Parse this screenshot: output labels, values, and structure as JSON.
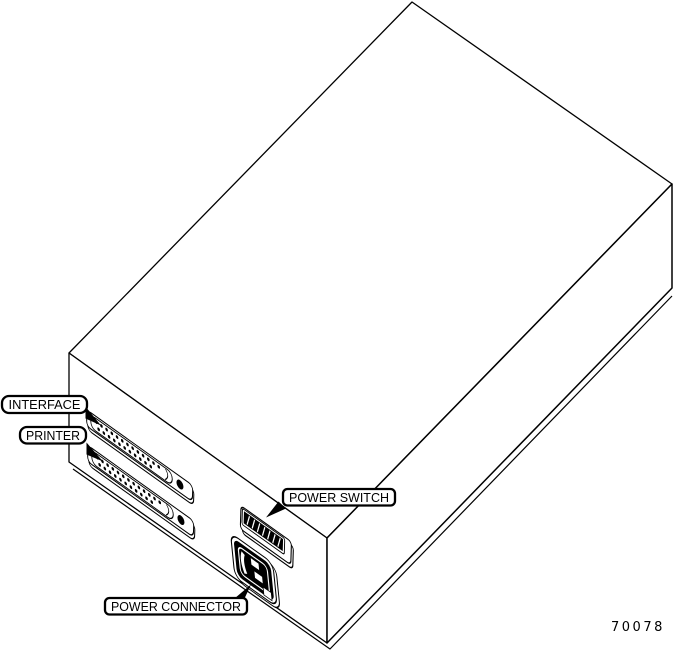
{
  "callouts": {
    "interface": "INTERFACE",
    "printer": "PRINTER",
    "power_switch": "POWER SWITCH",
    "power_connector": "POWER CONNECTOR"
  },
  "figure_number": "70078",
  "illustration": {
    "subject": "Isometric rear view of equipment enclosure showing two D-sub ports, rocker power switch and IEC power inlet",
    "dsub_pins": {
      "top_row": 13,
      "bottom_row": 12
    },
    "colors": {
      "line": "#000000",
      "background": "#ffffff"
    }
  }
}
